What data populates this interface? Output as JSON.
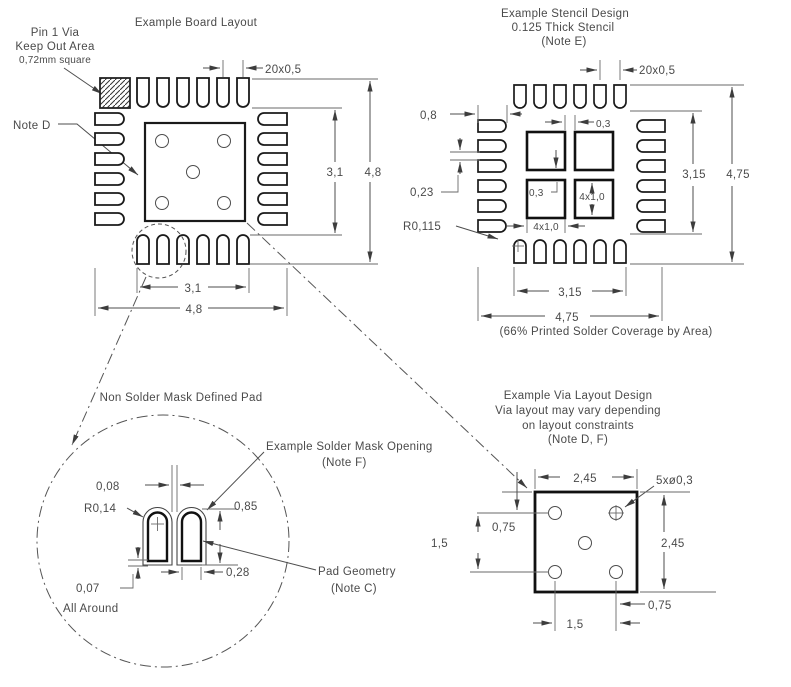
{
  "board": {
    "title": "Example Board Layout",
    "pin1_line1": "Pin 1 Via",
    "pin1_line2": "Keep Out Area",
    "pin1_line3": "0,72mm square",
    "note_d": "Note D",
    "dim_pitch": "20x0,5",
    "dim_inner_v": "3,1",
    "dim_outer_v": "4,8",
    "dim_inner_h": "3,1",
    "dim_outer_h": "4,8"
  },
  "stencil": {
    "title1": "Example Stencil Design",
    "title2": "0.125 Thick Stencil",
    "title3": "(Note E)",
    "dim_pitch": "20x0,5",
    "dim_pad_len": "0,8",
    "dim_gap": "0,23",
    "dim_radius": "R0,115",
    "dim_sq_gap_h": "0,3",
    "dim_sq_gap_v": "0,3",
    "dim_sq_h": "4x1,0",
    "dim_sq_w": "4x1,0",
    "dim_inner_v": "3,15",
    "dim_outer_v": "4,75",
    "dim_inner_h": "3,15",
    "dim_outer_h": "4,75",
    "coverage_note": "(66% Printed Solder Coverage by Area)"
  },
  "detail": {
    "title": "Non Solder Mask Defined Pad",
    "mask_label1": "Example Solder Mask Opening",
    "mask_label2": "(Note F)",
    "pad_label1": "Pad Geometry",
    "pad_label2": "(Note C)",
    "dim_gap": "0,08",
    "dim_radius": "R0,14",
    "dim_height": "0,85",
    "dim_width": "0,28",
    "dim_offset": "0,07",
    "dim_offset_note": "All Around"
  },
  "via": {
    "title1": "Example Via Layout Design",
    "title2": "Via layout may vary depending",
    "title3": "on layout constraints",
    "title4": "(Note D, F)",
    "dim_width": "2,45",
    "dim_vias": "5xø0,3",
    "dim_top": "0,75",
    "dim_row_gap": "1,5",
    "dim_height": "2,45",
    "dim_right": "0,75",
    "dim_col_gap": "1,5"
  }
}
